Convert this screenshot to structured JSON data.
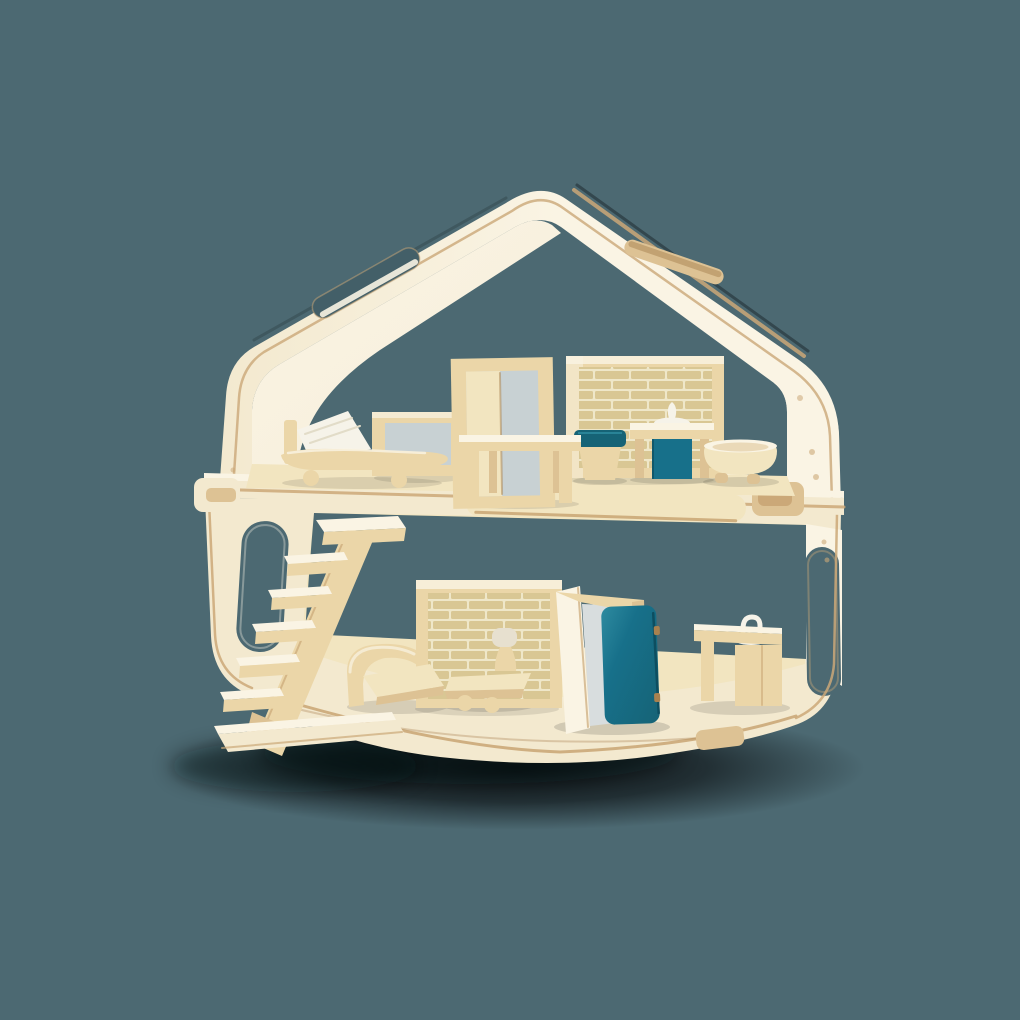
{
  "scene": {
    "description": "Two-storey plywood toy dollhouse with pitched roof, carry-handle slots, staircase and modern wooden furniture with teal accents, photographed on a dark slate-teal background",
    "type": "product-photo",
    "floors": 2
  },
  "palette": {
    "bg": "#4C6972",
    "shadow": "#06090B",
    "cream": "#F3E9CF",
    "creamBright": "#FAF4E4",
    "innerFace": "#F7EEDA",
    "woodSurface": "#F2E5C0",
    "wood": "#EBD6A8",
    "woodMid": "#DDC294",
    "woodTan": "#CBA878",
    "woodDark": "#A8814F",
    "brick": "#D9C794",
    "brickMortar": "#EFE7C9",
    "teal": "#17708A",
    "tealDark": "#166376",
    "tealLight": "#2E8BA0",
    "tealEdge": "#0D4E60",
    "pane": "#C8D1D3",
    "paneLight": "#D8DDDE",
    "white": "#F6F3E9",
    "lampShade": "#E7E0CF",
    "pillowShade": "#E2DCC8",
    "slotDark": "#435F68"
  },
  "objects": {
    "house": {
      "structure": [
        "pitched roof with two carry-handle slots",
        "upper floor module",
        "middle floor platform with wooden latches",
        "lower floor module with rounded corners",
        "pill-shaped window left wall",
        "pill-shaped window right wall"
      ],
      "upper_floor": [
        "bed with white pillow",
        "tv frame",
        "open doorway",
        "wooden table",
        "brick wall panel",
        "toilet with teal seat",
        "sink vanity with teal cabinet and white faucet",
        "round bathtub bowl"
      ],
      "lower_floor": [
        "open staircase with cantilevered steps",
        "curved-back sofa",
        "brick wall panel",
        "table lamp on coffee table",
        "doorway with open teal door",
        "kitchen sink counter with gooseneck faucet"
      ]
    }
  }
}
